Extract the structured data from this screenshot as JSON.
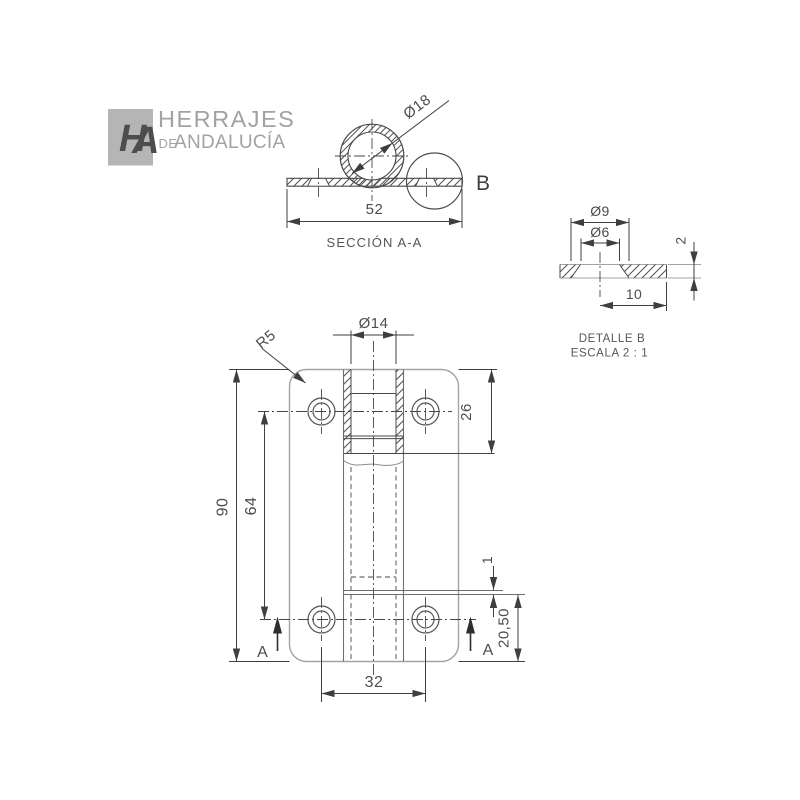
{
  "logo": {
    "monogram_h": "H",
    "monogram_a": "A",
    "name_line1": "HERRAJES",
    "name_line2_small": "DE",
    "name_line2": "ANDALUCÍA"
  },
  "section_view": {
    "title": "SECCIÓN A-A",
    "detail_marker": "B",
    "dim_knuckle_diameter": "Ø18",
    "dim_width": "52"
  },
  "detail_view": {
    "title": "DETALLE B",
    "scale_note": "ESCALA 2 : 1",
    "dim_countersink_diameter": "Ø9",
    "dim_hole_diameter": "Ø6",
    "dim_thickness": "2",
    "dim_width": "10"
  },
  "front_view": {
    "dim_knuckle_bore": "Ø14",
    "dim_corner_radius": "R5",
    "dim_total_height": "90",
    "dim_hole_spacing_vertical": "64",
    "dim_knuckle_length": "26",
    "dim_hole_spacing_horizontal": "32",
    "dim_hole_bottom_offset": "20,50",
    "dim_step": "1",
    "cut_label_left": "A",
    "cut_label_right": "A"
  },
  "colors": {
    "background": "#ffffff",
    "edge_gray": "#a3a3a3",
    "line_dark": "#474747",
    "text": "#4d4d4d",
    "logo_gray": "#a9a9a9"
  }
}
